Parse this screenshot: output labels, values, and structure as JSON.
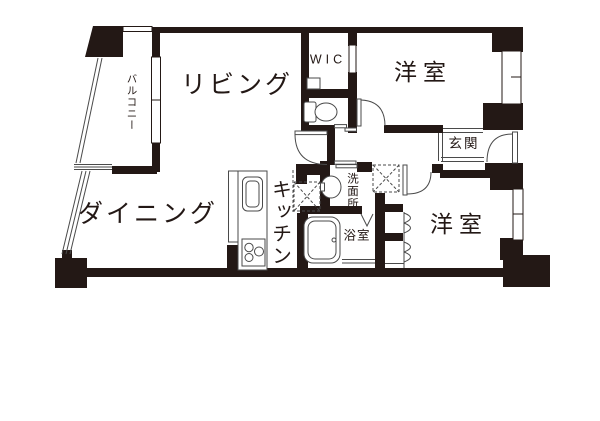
{
  "floorplan": {
    "rooms": {
      "living": "リビング",
      "dining": "ダイニング",
      "kitchen": "キッチン",
      "western_room_top": "洋室",
      "western_room_bottom": "洋室",
      "walk_in_closet": "WIC",
      "entrance": "玄関",
      "washroom": "洗面所",
      "bathroom": "浴室",
      "balcony": "バルコニー"
    },
    "colors": {
      "wall": "#231815",
      "thin_line": "#4a4a4a",
      "background": "#ffffff"
    }
  }
}
